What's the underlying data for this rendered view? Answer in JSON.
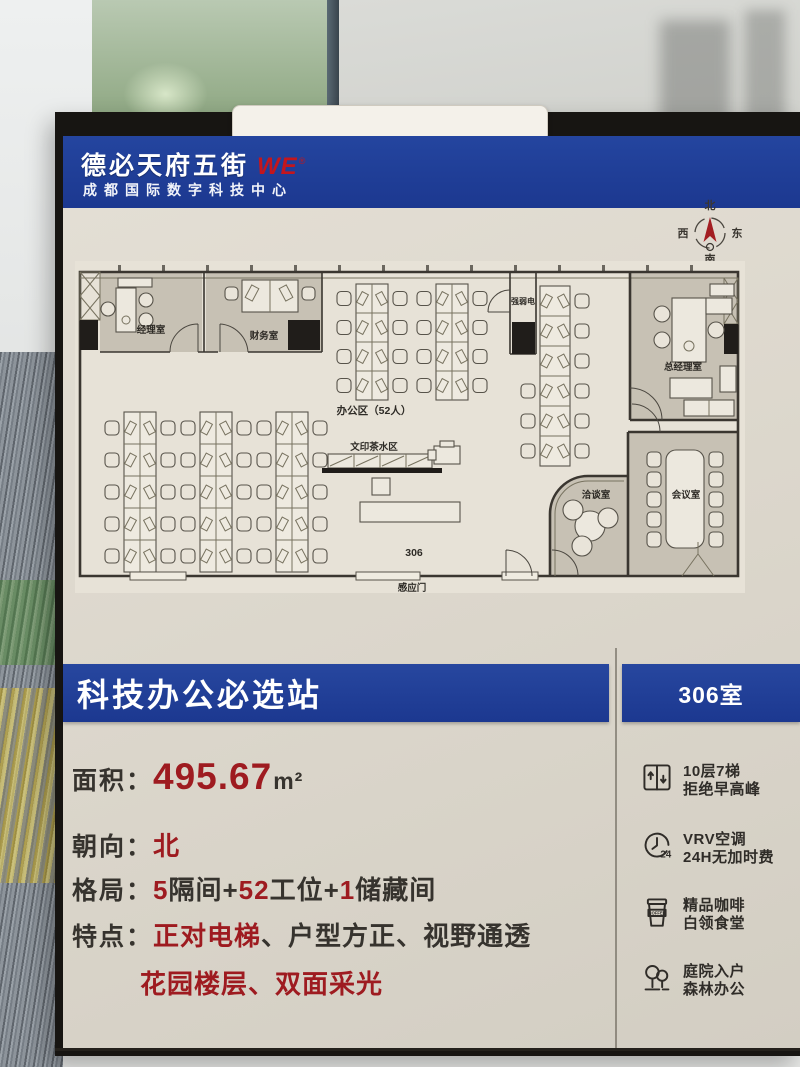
{
  "brand": {
    "name": "德必天府五街",
    "logo": "WE",
    "trademark": "®",
    "subtitle": "成都国际数字科技中心"
  },
  "compass": {
    "north": "北",
    "south": "南",
    "east": "东",
    "west": "西"
  },
  "floorplan": {
    "rooms": {
      "manager": "经理室",
      "finance": "财务室",
      "utility": "强弱电",
      "general_manager": "总经理室",
      "negotiation": "洽谈室",
      "conference": "会议室"
    },
    "areas": {
      "office_area": "办公区（52人）",
      "print_tea": "文印茶水区",
      "room_number": "306",
      "sensor_door": "感应门"
    }
  },
  "banner": {
    "title": "科技办公必选站",
    "room": "306室"
  },
  "details": {
    "area": {
      "label": "面积：",
      "value": "495.67",
      "unit": "m²"
    },
    "orientation": {
      "label": "朝向：",
      "value": "北"
    },
    "layout": {
      "label": "格局：",
      "parts": [
        {
          "text": "5",
          "red": true
        },
        {
          "text": "隔间+",
          "red": false
        },
        {
          "text": "52",
          "red": true
        },
        {
          "text": "工位+",
          "red": false
        },
        {
          "text": "1",
          "red": true
        },
        {
          "text": "储藏间",
          "red": false
        }
      ]
    },
    "features": {
      "label": "特点：",
      "line1": [
        {
          "text": "正对电梯",
          "red": true
        },
        {
          "text": "、",
          "red": false
        },
        {
          "text": "户型方正",
          "red": false
        },
        {
          "text": "、",
          "red": false
        },
        {
          "text": "视野通透",
          "red": false
        }
      ],
      "line2": [
        {
          "text": "花园楼层",
          "red": true
        },
        {
          "text": "、",
          "red": true
        },
        {
          "text": "双面采光",
          "red": true
        }
      ]
    }
  },
  "amenities": [
    {
      "icon": "elevator-icon",
      "line1": "10层7梯",
      "line2": "拒绝早高峰"
    },
    {
      "icon": "clock-24-icon",
      "line1": "VRV空调",
      "line2": "24H无加时费",
      "badge": "24"
    },
    {
      "icon": "coffee-icon",
      "line1": "精品咖啡",
      "line2": "白领食堂",
      "badge": "COFFEE"
    },
    {
      "icon": "trees-icon",
      "line1": "庭院入户",
      "line2": "森林办公"
    }
  ],
  "colors": {
    "brand_blue": "#1e3c98",
    "accent_red": "#9e1b20",
    "logo_red": "#c4161d"
  }
}
